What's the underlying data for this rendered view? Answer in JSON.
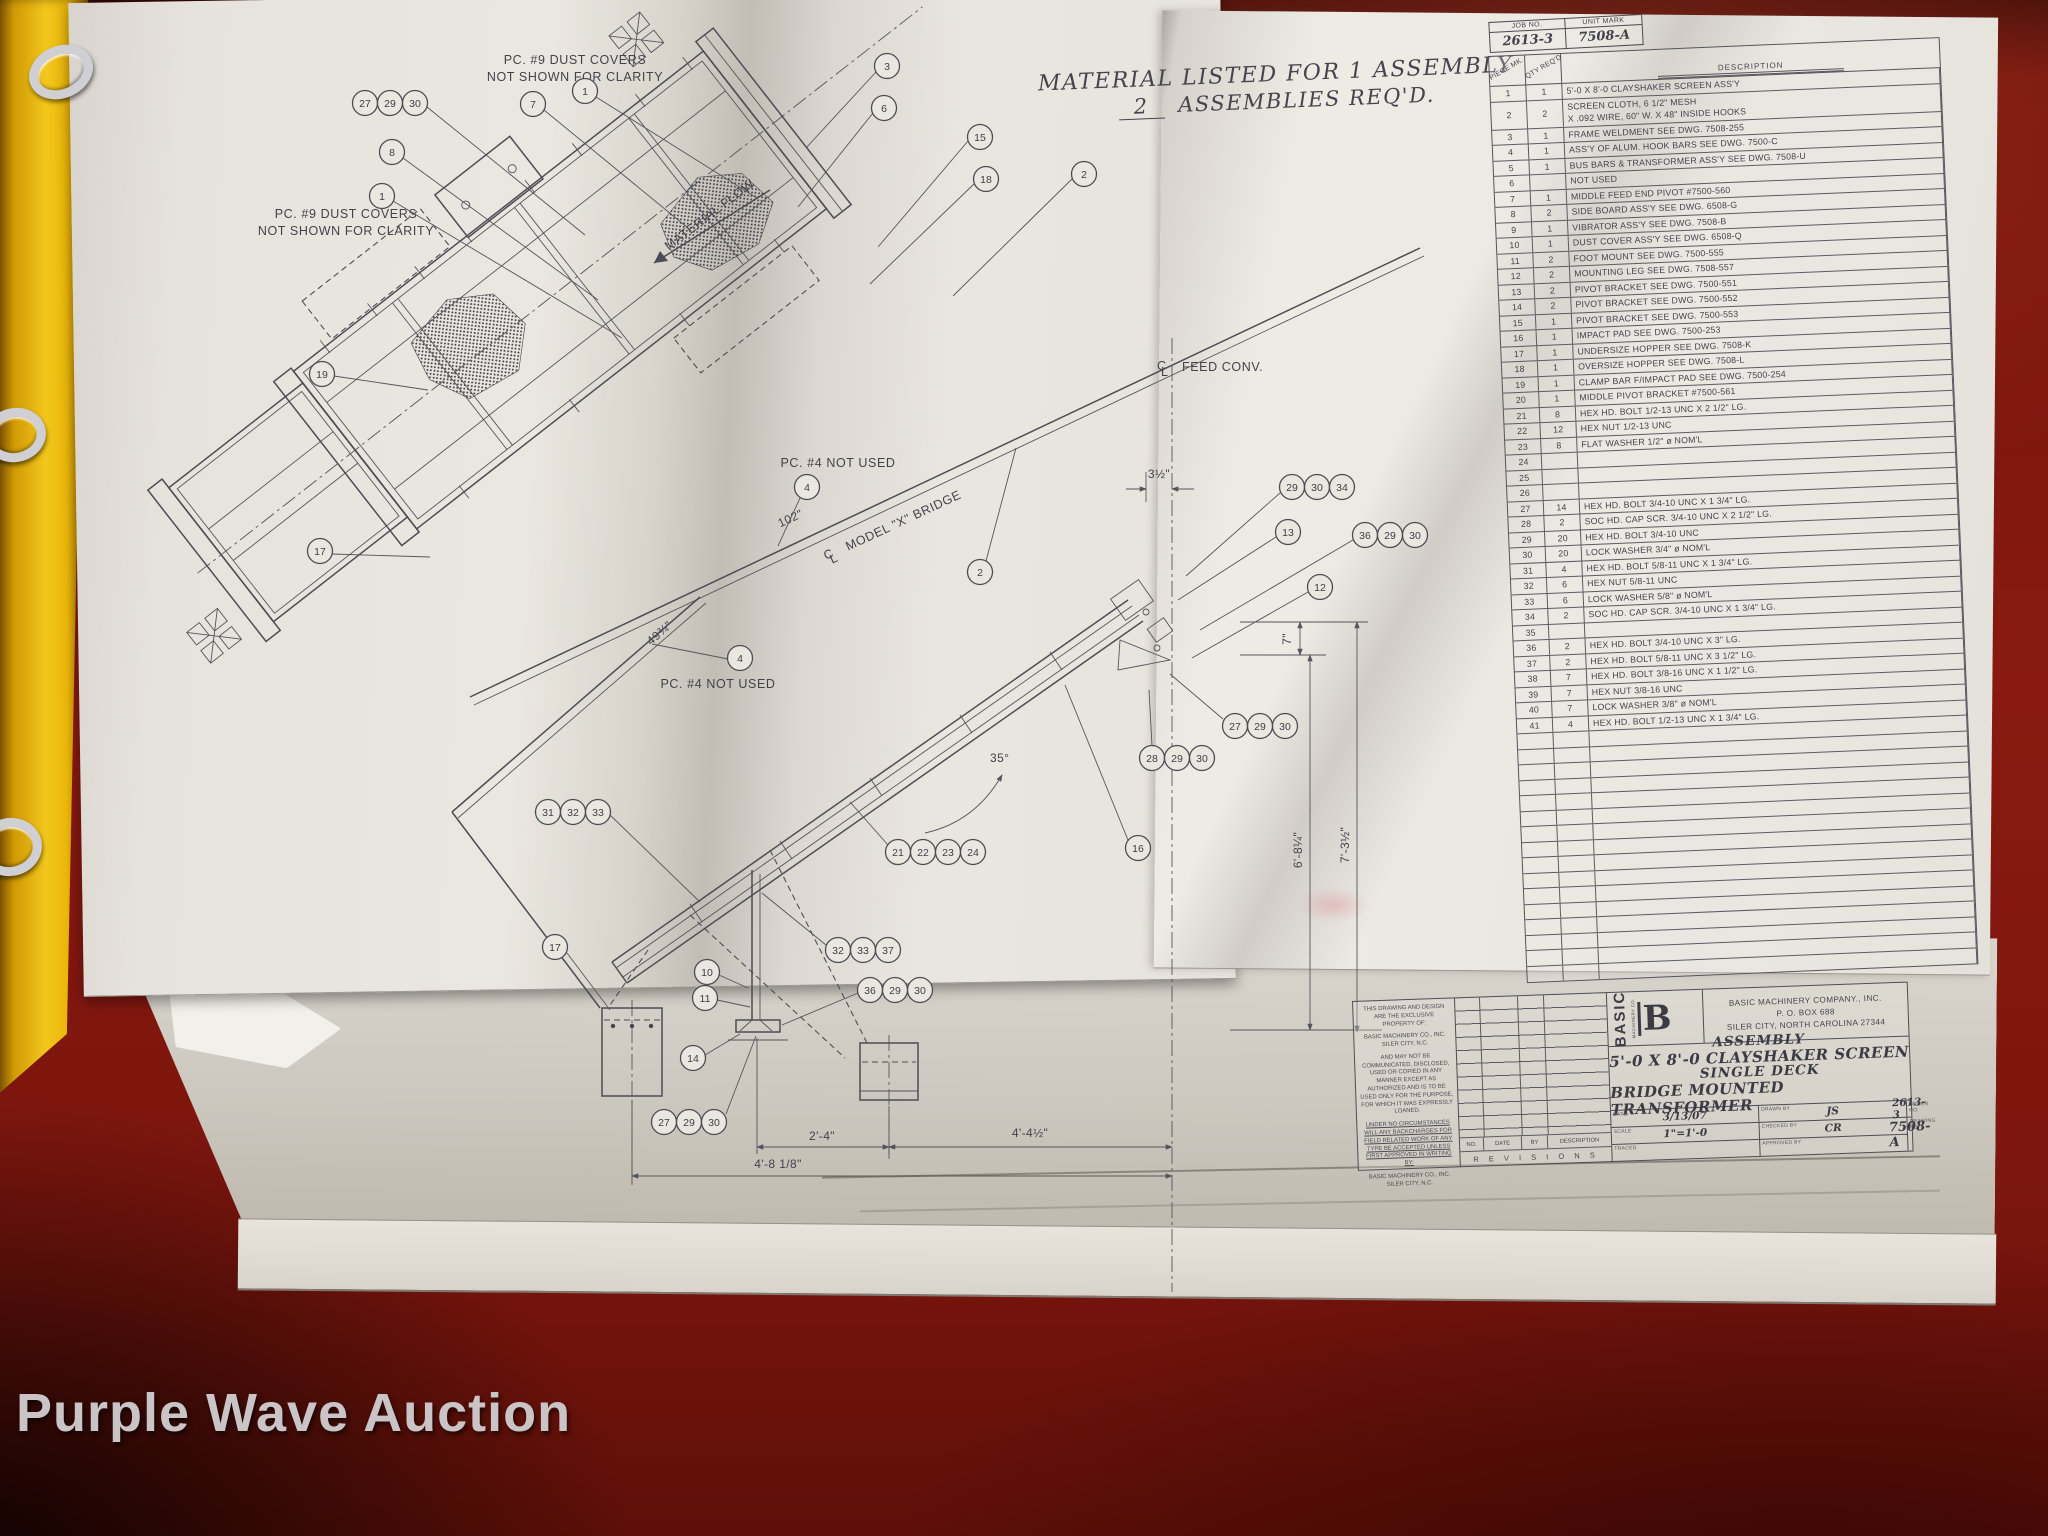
{
  "watermark": "Purple Wave Auction",
  "job_box": {
    "job_label": "JOB NO.",
    "job_value": "2613-3",
    "unit_label": "UNIT MARK",
    "unit_value": "7508-A"
  },
  "material_note": {
    "line1": "MATERIAL LISTED FOR 1 ASSEMBLY",
    "qty": "2",
    "line2": "ASSEMBLIES REQ'D."
  },
  "parts_table": {
    "headers": {
      "piece": "PIECE MK.",
      "qty": "QTY REQ'D",
      "desc": "DESCRIPTION"
    },
    "rows": [
      {
        "pc": "1",
        "qty": "1",
        "desc": "5'-0 X 8'-0 CLAYSHAKER SCREEN ASS'Y"
      },
      {
        "pc": "2",
        "qty": "2",
        "desc": "SCREEN CLOTH, 6 1/2\" MESH",
        "desc2": "X .092 WIRE, 60\" W. X 48\" INSIDE HOOKS"
      },
      {
        "pc": "3",
        "qty": "1",
        "desc": "FRAME WELDMENT SEE DWG. 7508-255"
      },
      {
        "pc": "4",
        "qty": "1",
        "desc": "ASS'Y OF ALUM. HOOK BARS SEE DWG. 7500-C"
      },
      {
        "pc": "5",
        "qty": "1",
        "desc": "BUS BARS & TRANSFORMER ASS'Y SEE DWG. 7508-U"
      },
      {
        "pc": "6",
        "qty": "",
        "desc": "NOT USED"
      },
      {
        "pc": "7",
        "qty": "1",
        "desc": "MIDDLE FEED END PIVOT #7500-560"
      },
      {
        "pc": "8",
        "qty": "2",
        "desc": "SIDE BOARD ASS'Y SEE DWG. 6508-G"
      },
      {
        "pc": "9",
        "qty": "1",
        "desc": "VIBRATOR ASS'Y SEE DWG. 7508-B"
      },
      {
        "pc": "10",
        "qty": "1",
        "desc": "DUST COVER ASS'Y SEE DWG. 6508-Q"
      },
      {
        "pc": "11",
        "qty": "2",
        "desc": "FOOT MOUNT SEE DWG. 7500-555"
      },
      {
        "pc": "12",
        "qty": "2",
        "desc": "MOUNTING LEG SEE DWG. 7508-557"
      },
      {
        "pc": "13",
        "qty": "2",
        "desc": "PIVOT BRACKET SEE DWG. 7500-551"
      },
      {
        "pc": "14",
        "qty": "2",
        "desc": "PIVOT BRACKET SEE DWG. 7500-552"
      },
      {
        "pc": "15",
        "qty": "1",
        "desc": "PIVOT BRACKET SEE DWG. 7500-553"
      },
      {
        "pc": "16",
        "qty": "1",
        "desc": "IMPACT PAD SEE DWG. 7500-253"
      },
      {
        "pc": "17",
        "qty": "1",
        "desc": "UNDERSIZE HOPPER SEE DWG. 7508-K"
      },
      {
        "pc": "18",
        "qty": "1",
        "desc": "OVERSIZE HOPPER SEE DWG. 7508-L"
      },
      {
        "pc": "19",
        "qty": "1",
        "desc": "CLAMP BAR F/IMPACT PAD SEE DWG. 7500-254"
      },
      {
        "pc": "20",
        "qty": "1",
        "desc": "MIDDLE PIVOT BRACKET #7500-561"
      },
      {
        "pc": "21",
        "qty": "8",
        "desc": "HEX HD. BOLT 1/2-13 UNC X 2 1/2\" LG."
      },
      {
        "pc": "22",
        "qty": "12",
        "desc": "HEX NUT 1/2-13 UNC"
      },
      {
        "pc": "23",
        "qty": "8",
        "desc": "FLAT WASHER 1/2\" ø NOM'L"
      },
      {
        "pc": "24",
        "qty": "",
        "desc": ""
      },
      {
        "pc": "25",
        "qty": "",
        "desc": ""
      },
      {
        "pc": "26",
        "qty": "",
        "desc": ""
      },
      {
        "pc": "27",
        "qty": "14",
        "desc": "HEX HD. BOLT 3/4-10 UNC X 1 3/4\" LG."
      },
      {
        "pc": "28",
        "qty": "2",
        "desc": "SOC HD. CAP SCR. 3/4-10 UNC X 2 1/2\" LG."
      },
      {
        "pc": "29",
        "qty": "20",
        "desc": "HEX HD. BOLT 3/4-10 UNC"
      },
      {
        "pc": "30",
        "qty": "20",
        "desc": "LOCK WASHER 3/4\" ø NOM'L"
      },
      {
        "pc": "31",
        "qty": "4",
        "desc": "HEX HD. BOLT 5/8-11 UNC X 1 3/4\" LG."
      },
      {
        "pc": "32",
        "qty": "6",
        "desc": "HEX NUT 5/8-11 UNC"
      },
      {
        "pc": "33",
        "qty": "6",
        "desc": "LOCK WASHER 5/8\" ø NOM'L"
      },
      {
        "pc": "34",
        "qty": "2",
        "desc": "SOC HD. CAP SCR. 3/4-10 UNC X 1 3/4\" LG."
      },
      {
        "pc": "35",
        "qty": "",
        "desc": ""
      },
      {
        "pc": "36",
        "qty": "2",
        "desc": "HEX HD. BOLT 3/4-10 UNC X 3\" LG."
      },
      {
        "pc": "37",
        "qty": "2",
        "desc": "HEX HD. BOLT 5/8-11 UNC X 3 1/2\" LG."
      },
      {
        "pc": "38",
        "qty": "7",
        "desc": "HEX HD. BOLT 3/8-16 UNC X 1 1/2\" LG."
      },
      {
        "pc": "39",
        "qty": "7",
        "desc": "HEX NUT 3/8-16 UNC"
      },
      {
        "pc": "40",
        "qty": "7",
        "desc": "LOCK WASHER 3/8\" ø NOM'L"
      },
      {
        "pc": "41",
        "qty": "4",
        "desc": "HEX HD. BOLT 1/2-13 UNC X 1 3/4\" LG."
      },
      {
        "pc": "",
        "qty": "",
        "desc": ""
      },
      {
        "pc": "",
        "qty": "",
        "desc": ""
      },
      {
        "pc": "",
        "qty": "",
        "desc": ""
      },
      {
        "pc": "",
        "qty": "",
        "desc": ""
      },
      {
        "pc": "",
        "qty": "",
        "desc": ""
      },
      {
        "pc": "",
        "qty": "",
        "desc": ""
      },
      {
        "pc": "",
        "qty": "",
        "desc": ""
      },
      {
        "pc": "",
        "qty": "",
        "desc": ""
      },
      {
        "pc": "",
        "qty": "",
        "desc": ""
      },
      {
        "pc": "",
        "qty": "",
        "desc": ""
      },
      {
        "pc": "",
        "qty": "",
        "desc": ""
      },
      {
        "pc": "",
        "qty": "",
        "desc": ""
      },
      {
        "pc": "",
        "qty": "",
        "desc": ""
      },
      {
        "pc": "",
        "qty": "",
        "desc": ""
      },
      {
        "pc": "",
        "qty": "",
        "desc": ""
      },
      {
        "pc": "",
        "qty": "",
        "desc": ""
      }
    ]
  },
  "drawing": {
    "notes": {
      "dust_line1": "PC. #9 DUST COVERS",
      "dust_line2": "NOT SHOWN FOR CLARITY",
      "pc4": "PC. #4 NOT USED",
      "material_flow": "MATERIAL FLOW",
      "feed_conv": "FEED CONV.",
      "bridge_cl": "MODEL \"X\" BRIDGE",
      "cl_c": "C",
      "cl_l": "L"
    },
    "dims": {
      "bridge_length": "102\"",
      "frame_edge": "49¾\"",
      "deck_angle": "35°",
      "cl_offset": "3½\"",
      "pivot_drop": "7\"",
      "height_inner": "6'-8¼\"",
      "height_outer": "7'-3½\"",
      "span_mid": "2'-4\"",
      "span_right": "4'-4½\"",
      "span_left": "4'-8 1/8\""
    },
    "bubbles": [
      "27",
      "29",
      "30",
      "8",
      "1",
      "7",
      "1",
      "3",
      "6",
      "15",
      "18",
      "2",
      "19",
      "17",
      "2",
      "4",
      "4",
      "31",
      "32",
      "33",
      "21",
      "22",
      "23",
      "24",
      "16",
      "29",
      "30",
      "34",
      "13",
      "36",
      "29",
      "30",
      "12",
      "27",
      "29",
      "30",
      "28",
      "29",
      "30",
      "32",
      "33",
      "37",
      "36",
      "29",
      "30",
      "10",
      "11",
      "14",
      "27",
      "29",
      "30",
      "17"
    ]
  },
  "title_block": {
    "property_note_1": "THIS DRAWING AND DESIGN ARE THE EXCLUSIVE PROPERTY OF:",
    "property_note_2": "BASIC MACHINERY CO., INC. SILER CITY, N.C.",
    "property_note_3": "AND MAY NOT BE COMMUNICATED, DISCLOSED, USED OR COPIED IN ANY MANNER EXCEPT AS AUTHORIZED AND IS TO BE USED ONLY FOR THE PURPOSE, FOR WHICH IT WAS EXPRESSLY LOANED.",
    "property_note_4": "UNDER NO CIRCUMSTANCES WILL ANY BACKCHARGES FOR FIELD RELATED WORK OF ANY TYPE BE ACCEPTED UNLESS FIRST APPROVED IN WRITING BY:",
    "property_note_5": "BASIC MACHINERY CO., INC. SILER CITY, N.C.",
    "revisions": {
      "no": "NO.",
      "date": "DATE",
      "by": "BY",
      "description": "DESCRIPTION",
      "strip": "R E V I S I O N S"
    },
    "logo": {
      "vertical": "BASIC",
      "sub": "MACHINERY CO.",
      "letter": "B"
    },
    "company": {
      "line1": "BASIC MACHINERY COMPANY., INC.",
      "line2": "P. O. BOX 688",
      "line3": "SILER CITY, NORTH CAROLINA 27344"
    },
    "title": {
      "line1": "ASSEMBLY",
      "line2": "5'-0 X 8'-0 CLAYSHAKER SCREEN",
      "line3": "SINGLE DECK",
      "line4": "BRIDGE MOUNTED TRANSFORMER"
    },
    "fields": {
      "date_label": "DATE",
      "date": "3/13/07",
      "drawn_label": "DRAWN BY",
      "drawn": "JS",
      "order_label": "ORDER NO.",
      "order": "2613-3",
      "scale_label": "SCALE",
      "scale": "1\"=1'-0",
      "checked_label": "CHECKED BY",
      "checked": "CR",
      "dwg_label": "DRAWING NO.",
      "dwg": "7508-A",
      "traced_label": "TRACED",
      "approved_label": "APPROVED BY"
    }
  }
}
